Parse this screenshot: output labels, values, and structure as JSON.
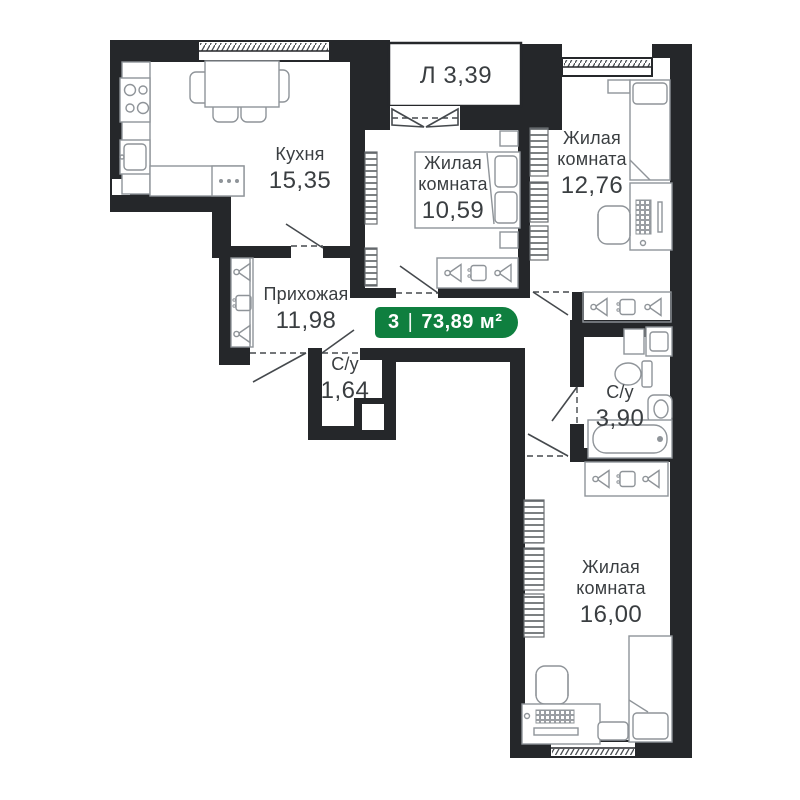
{
  "badge": {
    "rooms_count": "3",
    "separator": "|",
    "area": "73,89 м²"
  },
  "rooms": [
    {
      "id": "loggia",
      "label": "Л",
      "area": "3,39"
    },
    {
      "id": "kitchen",
      "label": "Кухня",
      "area": "15,35"
    },
    {
      "id": "living-room-1",
      "label": "Жилая комната",
      "area": "10,59"
    },
    {
      "id": "living-room-2",
      "label": "Жилая комната",
      "area": "12,76"
    },
    {
      "id": "hallway",
      "label": "Прихожая",
      "area": "11,98"
    },
    {
      "id": "bathroom-small",
      "label": "С/у",
      "area": "1,64"
    },
    {
      "id": "bathroom-large",
      "label": "С/у",
      "area": "3,90"
    },
    {
      "id": "living-room-3",
      "label": "Жилая комната",
      "area": "16,00"
    }
  ],
  "colors": {
    "wall": "#25272a",
    "badge_green": "#0f7f3f",
    "label_text": "#3a3e41",
    "furniture_line": "#8f9499",
    "background": "#ffffff"
  },
  "icons": [
    "hanger-icon",
    "shelf-box-icon",
    "stove-icon",
    "kitchen-sink-icon",
    "toilet-icon",
    "bathtub-icon",
    "washbasin-icon",
    "washer-icon",
    "bed-icon",
    "desk-icon",
    "chair-icon",
    "radiator-icon",
    "door-swing-icon"
  ]
}
